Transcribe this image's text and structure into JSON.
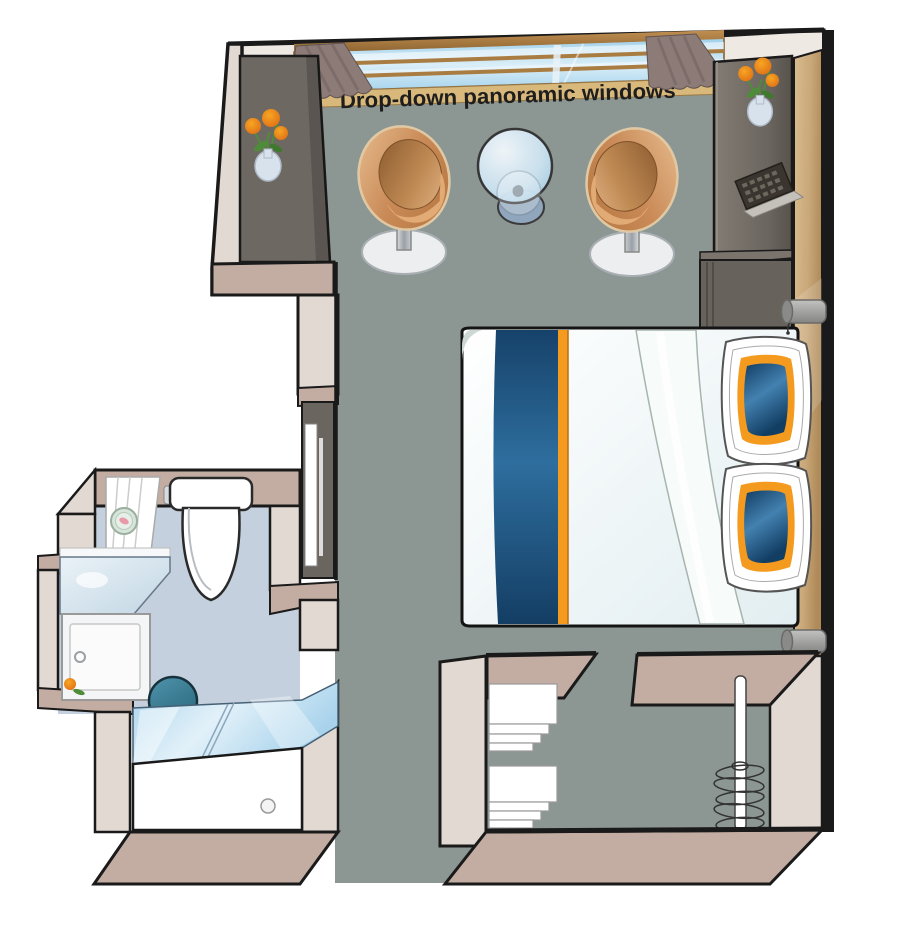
{
  "labels": {
    "window_note": "Drop-down panoramic windows"
  },
  "palette": {
    "outline": "#1A1A1A",
    "floor": "#8C9793",
    "bathroom_floor": "#C4D0DD",
    "wall": "#E3D9D3",
    "wall_top": "#C3ADA3",
    "wall_face": "#EFE9E4",
    "wood": "#C9A87A",
    "cabinet_dark": "#6E6862",
    "window_glass": "#AFD8EE",
    "window_frame": "#A97C42",
    "window_sill": "#D9B87C",
    "curtain": "#8D7B78",
    "chair_copper": "#C98A57",
    "bed_runner_blue": "#1D4E78",
    "accent_orange": "#F39A1F",
    "duvet_white": "#F3F9FB",
    "pillow_blue": "#1C4C76",
    "shower_glass": "#BCDFF2",
    "stool_teal": "#3E7D92",
    "lamp_gray": "#9C9C9A",
    "flower_orange": "#F08A1D",
    "leaf_green": "#4E8C3A",
    "vase_blue": "#D7E2EC"
  },
  "fixtures": {
    "cabin": [
      "panoramic-window",
      "curtain-left",
      "curtain-right",
      "window-sill",
      "armchair-left",
      "armchair-right",
      "glass-table",
      "double-bed",
      "bed-runner",
      "pillow-top",
      "pillow-bottom",
      "reading-lamp-top",
      "reading-lamp-bottom",
      "desk-unit",
      "desk-keyboard",
      "flower-vase-wall",
      "flower-vase-desk",
      "entrance-door",
      "towel-shelf-unit",
      "wardrobe-hanging-rail"
    ],
    "bathroom": [
      "toilet",
      "washbasin-counter",
      "vanity-cabinet",
      "round-mirror",
      "bathroom-shelves",
      "teal-stool",
      "shower-glass-door",
      "shower-tray",
      "shower-drain",
      "flower-pot"
    ]
  }
}
